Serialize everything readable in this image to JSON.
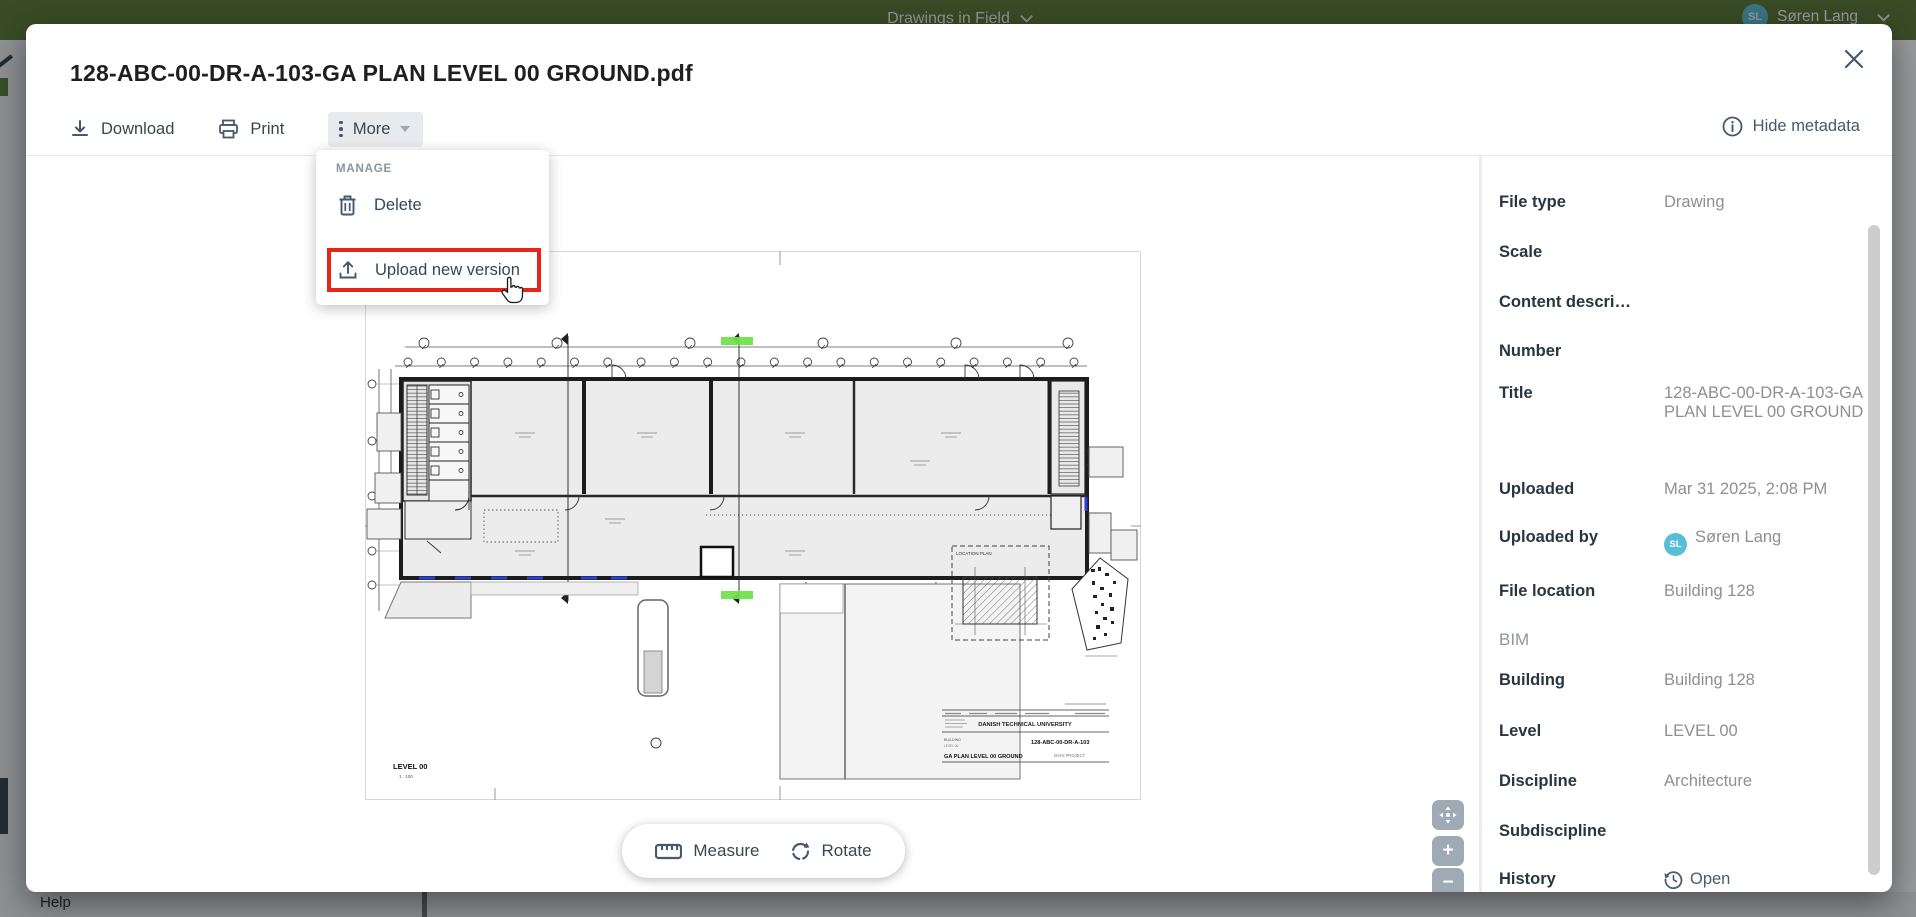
{
  "page": {
    "topbar": {
      "title": "Drawings in Field",
      "user_name": "Søren Lang",
      "user_initials": "SL"
    },
    "help_label": "Help"
  },
  "modal": {
    "title": "128-ABC-00-DR-A-103-GA PLAN LEVEL 00 GROUND.pdf",
    "toolbar": {
      "download": "Download",
      "print": "Print",
      "more": "More",
      "hide_metadata": "Hide metadata"
    },
    "menu": {
      "section": "MANAGE",
      "delete_label": "Delete",
      "upload_label": "Upload new version"
    },
    "viewer": {
      "measure": "Measure",
      "rotate": "Rotate",
      "zoom_in": "+",
      "zoom_out": "−"
    },
    "drawing": {
      "sheet_label": "LEVEL 00",
      "sheet_scale": "1 : 100",
      "location_plan_label": "LOCATION PLAN",
      "titleblock": {
        "university": "DANISH TECHNICAL UNIVERSITY",
        "number": "128-ABC-00-DR-A-103",
        "building_label": "BUILDING",
        "level_label": "LEVEL 00",
        "title": "GA PLAN LEVEL 00 GROUND",
        "project": "MAIN PROJECT"
      }
    },
    "metadata": {
      "bim_header": "BIM",
      "rows": [
        {
          "label": "File type",
          "value": "Drawing"
        },
        {
          "label": "Scale",
          "value": ""
        },
        {
          "label": "Content descri…",
          "value": ""
        },
        {
          "label": "Number",
          "value": ""
        },
        {
          "label": "Title",
          "value": "128-ABC-00-DR-A-103-GA PLAN LEVEL 00 GROUND"
        },
        {
          "label": "Uploaded",
          "value": "Mar 31 2025, 2:08 PM"
        },
        {
          "label": "Uploaded by",
          "value": "Søren Lang",
          "avatar": "SL"
        },
        {
          "label": "File location",
          "value": "Building 128"
        },
        {
          "label": "Building",
          "value": "Building 128"
        },
        {
          "label": "Level",
          "value": "LEVEL 00"
        },
        {
          "label": "Discipline",
          "value": "Architecture"
        },
        {
          "label": "Subdiscipline",
          "value": ""
        },
        {
          "label": "History",
          "value": "Open"
        }
      ]
    }
  },
  "colors": {
    "topbar_green": "#56752f",
    "highlight_red": "#e8231a",
    "marker_green": "#71e24c",
    "marker_blue": "#2a3fd4",
    "avatar_teal": "#58bdd8",
    "slate": "#44596b"
  }
}
